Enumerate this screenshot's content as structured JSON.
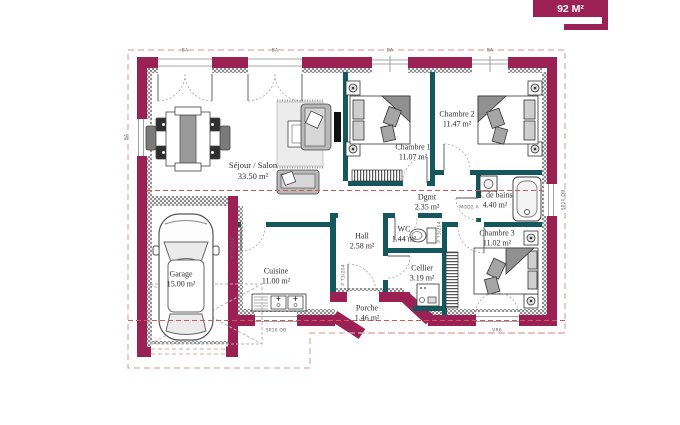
{
  "badge": {
    "text": "92 M²",
    "color": "#9b2154"
  },
  "rooms": {
    "sejour": {
      "name": "Séjour / Salon",
      "area": "33.50 m²"
    },
    "chambre1": {
      "name": "Chambre 1",
      "area": "11.07 m²"
    },
    "chambre2": {
      "name": "Chambre 2",
      "area": "11.47 m²"
    },
    "chambre3": {
      "name": "Chambre 3",
      "area": "11.02 m²"
    },
    "sdb": {
      "name": "S. de bains",
      "area": "4.40 m²"
    },
    "dgmt": {
      "name": "Dgmt",
      "area": "2.35 m²"
    },
    "wc": {
      "name": "WC",
      "area": "1.44 m²"
    },
    "hall": {
      "name": "Hall",
      "area": "2.58 m²"
    },
    "cellier": {
      "name": "Cellier",
      "area": "3.19 m²"
    },
    "cuisine": {
      "name": "Cuisine",
      "area": "11.00 m²"
    },
    "garage": {
      "name": "Garage",
      "area": "15.00 m²"
    },
    "porche": {
      "name": "Porche",
      "area": "1.46 m²"
    }
  },
  "windows": {
    "bay": "BA",
    "kitchen": "SP10 OB",
    "bath": "SP10 OB",
    "bedroom3": "VR6"
  },
  "doors": {
    "code": "P 73/204",
    "bath_code": "MOD2 A"
  },
  "colors": {
    "wall": "#9b2154",
    "partition": "#14585e",
    "section_line": "#cc5a5a",
    "boundary": "#e2a6a6"
  }
}
